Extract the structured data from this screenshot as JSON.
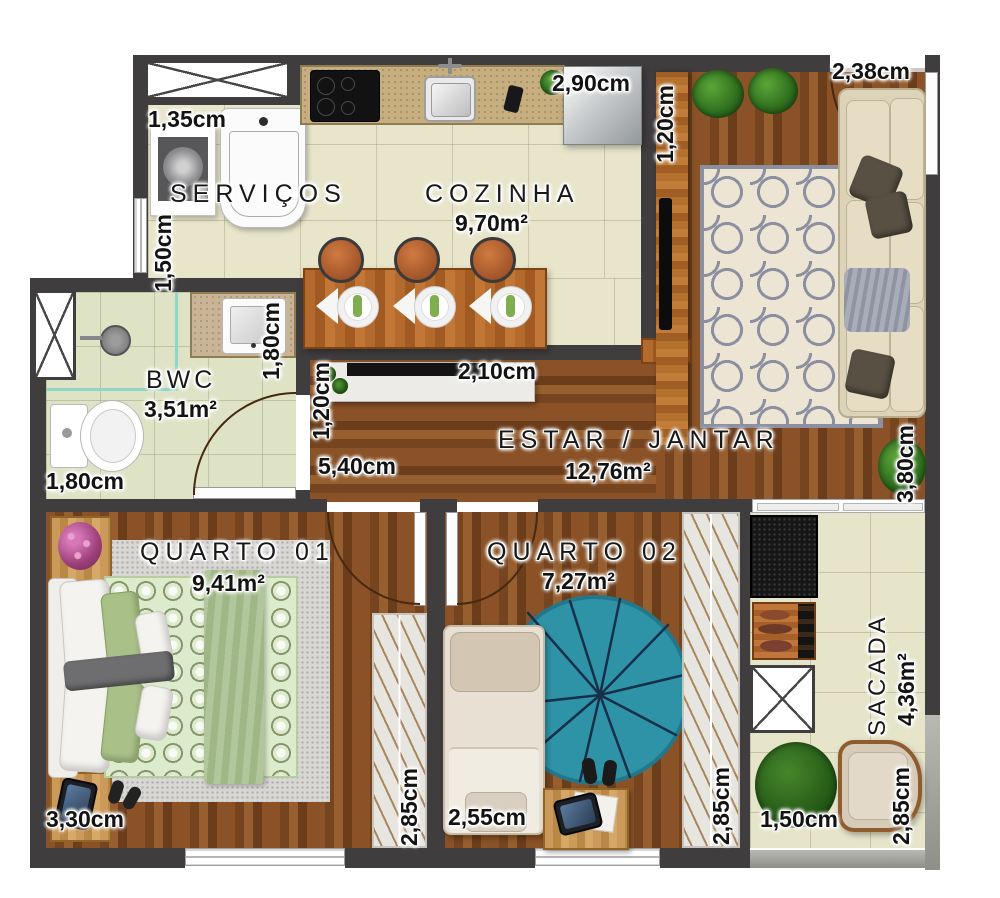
{
  "rooms": {
    "servicos": {
      "name": "SERVIÇOS"
    },
    "cozinha": {
      "name": "COZINHA",
      "area": "9,70m²"
    },
    "estar": {
      "name": "ESTAR / JANTAR",
      "area": "12,76m²"
    },
    "bwc": {
      "name": "BWC",
      "area": "3,51m²"
    },
    "quarto1": {
      "name": "QUARTO 01",
      "area": "9,41m²"
    },
    "quarto2": {
      "name": "QUARTO 02",
      "area": "7,27m²"
    },
    "sacada": {
      "name": "SACADA",
      "area": "4,36m²"
    }
  },
  "dims": {
    "servicos_tank": "1,35cm",
    "servicos_depth": "1,50cm",
    "cozinha_width": "2,90cm",
    "living_entry_depth": "1,20cm",
    "entrance_width": "2,38cm",
    "bwc_counter": "1,80cm",
    "bwc_width": "1,80cm",
    "hall_width": "1,20cm",
    "sideboard_width": "2,10cm",
    "estar_length": "5,40cm",
    "living_depth": "3,80cm",
    "quarto1_width": "3,30cm",
    "quarto1_closet": "2,85cm",
    "quarto2_width": "2,55cm",
    "quarto2_closet": "2,85cm",
    "sacada_width": "1,50cm",
    "sacada_depth": "2,85cm"
  },
  "colors": {
    "wall": "#3f3d3e",
    "wood": "#8a5226",
    "tile": "#e8e5cb",
    "bwc_tile": "#dfe3c6",
    "rug_living_pattern": "#8b8fa0",
    "rug_quarto2": "#2f93a8",
    "label_text": "#131313"
  }
}
